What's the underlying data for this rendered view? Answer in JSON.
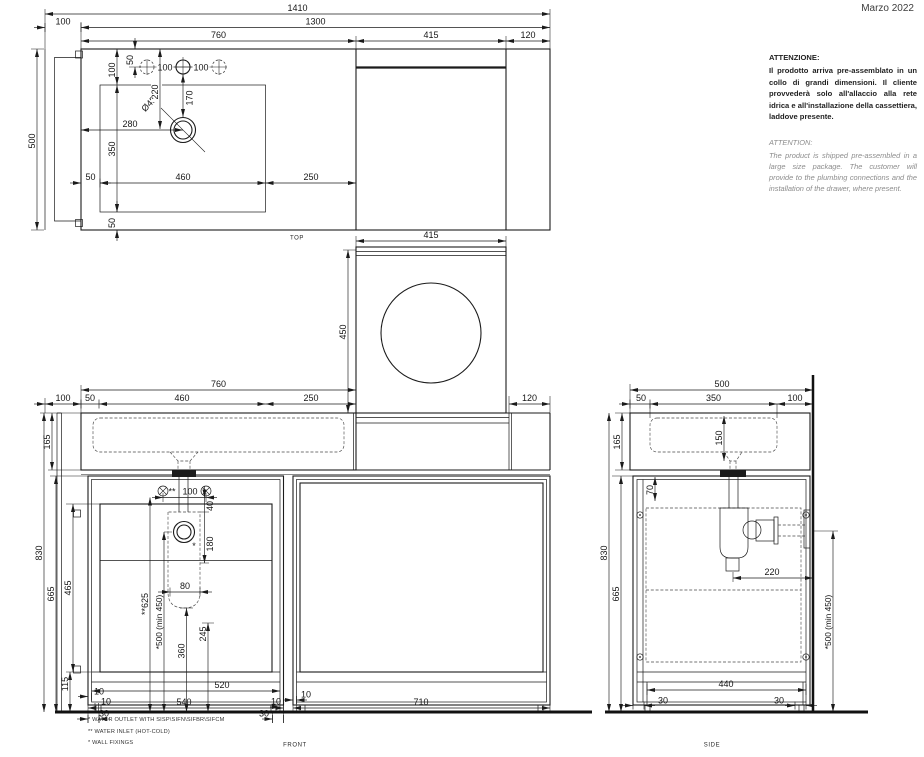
{
  "date": "Marzo 2022",
  "warning_it": {
    "title": "ATTENZIONE:",
    "body": "Il prodotto arriva pre-assemblato in un collo di grandi dimensioni. Il cliente provvederà solo all'allaccio alla rete idrica e all'installazione della cassettiera, laddove presente."
  },
  "warning_en": {
    "title": "ATTENTION:",
    "body": "The product is shipped pre-assembled in a large size package. The customer will provide to the plumbing connections and the installation of the drawer, where present."
  },
  "footnotes": {
    "f1": "*  WATER OUTLET WITH SISP\\SIFN\\SIFBR\\SIFCM",
    "f2": "** WATER INLET  (HOT-COLD)",
    "f3": "*  WALL FIXINGS"
  },
  "top": {
    "label": "TOP",
    "d1410": "1410",
    "d1300": "1300",
    "d100l": "100",
    "d760": "760",
    "d415": "415",
    "d120": "120",
    "d500": "500",
    "d50t": "50",
    "d100v": "100",
    "hole1": "100",
    "hole2": "100",
    "d220": "220",
    "d170": "170",
    "dia": "Ø45",
    "d280": "280",
    "d350": "350",
    "d50l": "50",
    "d460": "460",
    "d250": "250",
    "d50b": "50"
  },
  "panel": {
    "d415": "415",
    "d450": "450",
    "d120": "120"
  },
  "front": {
    "label": "FRONT",
    "d760": "760",
    "d100": "100",
    "d50": "50",
    "d460": "460",
    "d250": "250",
    "d165": "165",
    "d830": "830",
    "d665": "665",
    "d465": "465",
    "d115": "115",
    "mark2": "**",
    "inlet": "100",
    "d40": "40",
    "d180": "180",
    "d80": "80",
    "d625": "**625",
    "d500min": "*500 (min 450)",
    "d360": "360",
    "d245": "245",
    "mark1": "*",
    "b10a": "10",
    "b10b": "10",
    "b30a": "30",
    "b520": "520",
    "b540": "540",
    "b10c": "10",
    "b30b": "30",
    "b10d": "10",
    "b710": "710"
  },
  "side": {
    "label": "SIDE",
    "d500": "500",
    "d50": "50",
    "d350": "350",
    "d100": "100",
    "d165": "165",
    "d150": "150",
    "d70": "70",
    "d830": "830",
    "d665": "665",
    "d220": "220",
    "d500min": "*500 (min 450)",
    "b440": "440",
    "b30l": "30",
    "b30r": "30"
  }
}
